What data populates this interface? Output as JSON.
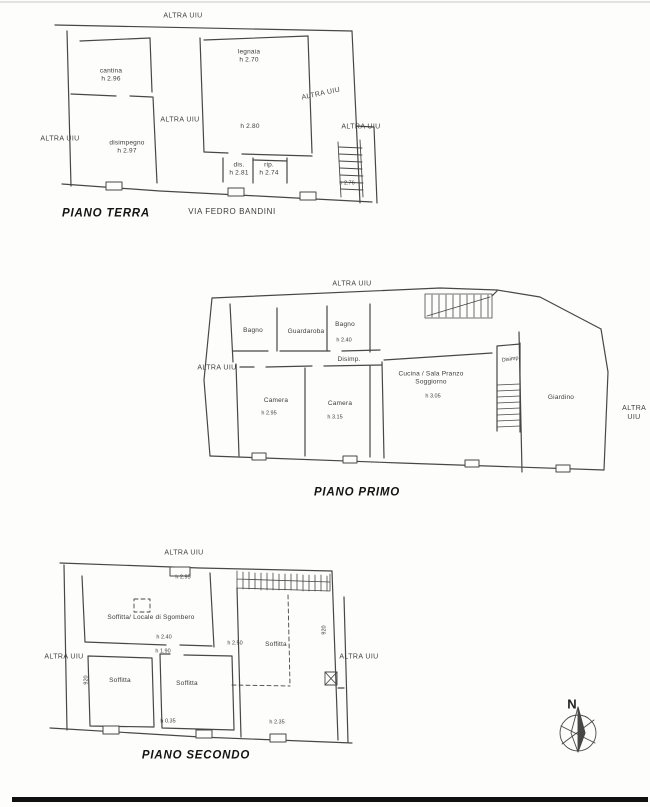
{
  "sheet": {
    "background": "#fdfdfc",
    "line_color": "#474747",
    "bottom_bar_color": "#101010"
  },
  "plans": {
    "terra": {
      "title": "PIANO TERRA",
      "street": "VIA FEDRO BANDINI",
      "labels": [
        {
          "name": "adjacent-unit",
          "text": "ALTRA UIU"
        },
        {
          "name": "room-cantina",
          "text": "cantina\nh 2.96"
        },
        {
          "name": "room-disimpegno",
          "text": "disimpegno\nh 2.97"
        },
        {
          "name": "adjacent-unit",
          "text": "ALTRA UIU"
        },
        {
          "name": "adjacent-unit",
          "text": "ALTRA UIU"
        },
        {
          "name": "room-legnaia",
          "text": "legnaia\nh 2.70"
        },
        {
          "name": "height-note",
          "text": "h 2.80"
        },
        {
          "name": "room-dis",
          "text": "dis.\nh 2.81"
        },
        {
          "name": "room-rip",
          "text": "rip.\nh 2.74"
        },
        {
          "name": "adjacent-unit",
          "text": "ALTRA UIU"
        },
        {
          "name": "adjacent-unit",
          "text": "ALTRA UIU"
        },
        {
          "name": "height-stairs",
          "text": "h 2.76"
        }
      ]
    },
    "primo": {
      "title": "PIANO PRIMO",
      "labels": [
        {
          "name": "adjacent-unit",
          "text": "ALTRA UIU"
        },
        {
          "name": "room-bagno-1",
          "text": "Bagno"
        },
        {
          "name": "room-guardaroba",
          "text": "Guardaroba"
        },
        {
          "name": "room-bagno-2",
          "text": "Bagno"
        },
        {
          "name": "height-note",
          "text": "h 2.40"
        },
        {
          "name": "room-disimp-1",
          "text": "Disimp."
        },
        {
          "name": "adjacent-unit",
          "text": "ALTRA UIU"
        },
        {
          "name": "room-camera-1",
          "text": "Camera"
        },
        {
          "name": "height-note",
          "text": "h 2.95"
        },
        {
          "name": "room-camera-2",
          "text": "Camera"
        },
        {
          "name": "height-note",
          "text": "h 3.15"
        },
        {
          "name": "room-cucina",
          "text": "Cucina / Sala Pranzo\nSoggiorno"
        },
        {
          "name": "height-note",
          "text": "h 3.05"
        },
        {
          "name": "room-disimp-2",
          "text": "Disimp."
        },
        {
          "name": "area-giardino",
          "text": "Giardino"
        },
        {
          "name": "adjacent-unit",
          "text": "ALTRA UIU"
        }
      ]
    },
    "secondo": {
      "title": "PIANO SECONDO",
      "labels": [
        {
          "name": "adjacent-unit",
          "text": "ALTRA UIU"
        },
        {
          "name": "height-note",
          "text": "h 2.95"
        },
        {
          "name": "room-soffitta-sgombero",
          "text": "Soffitta/ Locale di Sgombero"
        },
        {
          "name": "height-note",
          "text": "h 2.40"
        },
        {
          "name": "height-note",
          "text": "h 1.90"
        },
        {
          "name": "room-soffitta-1",
          "text": "Soffitta"
        },
        {
          "name": "room-soffitta-2",
          "text": "Soffitta"
        },
        {
          "name": "height-note",
          "text": "h 0.35"
        },
        {
          "name": "height-note",
          "text": "h 2.50"
        },
        {
          "name": "room-soffitta-3",
          "text": "Soffitta"
        },
        {
          "name": "height-note",
          "text": "h 2.35"
        },
        {
          "name": "dimension",
          "text": "920"
        },
        {
          "name": "dimension",
          "text": "920"
        },
        {
          "name": "adjacent-unit",
          "text": "ALTRA UIU"
        },
        {
          "name": "adjacent-unit",
          "text": "ALTRA UIU"
        }
      ]
    }
  },
  "compass": {
    "north": "N"
  }
}
